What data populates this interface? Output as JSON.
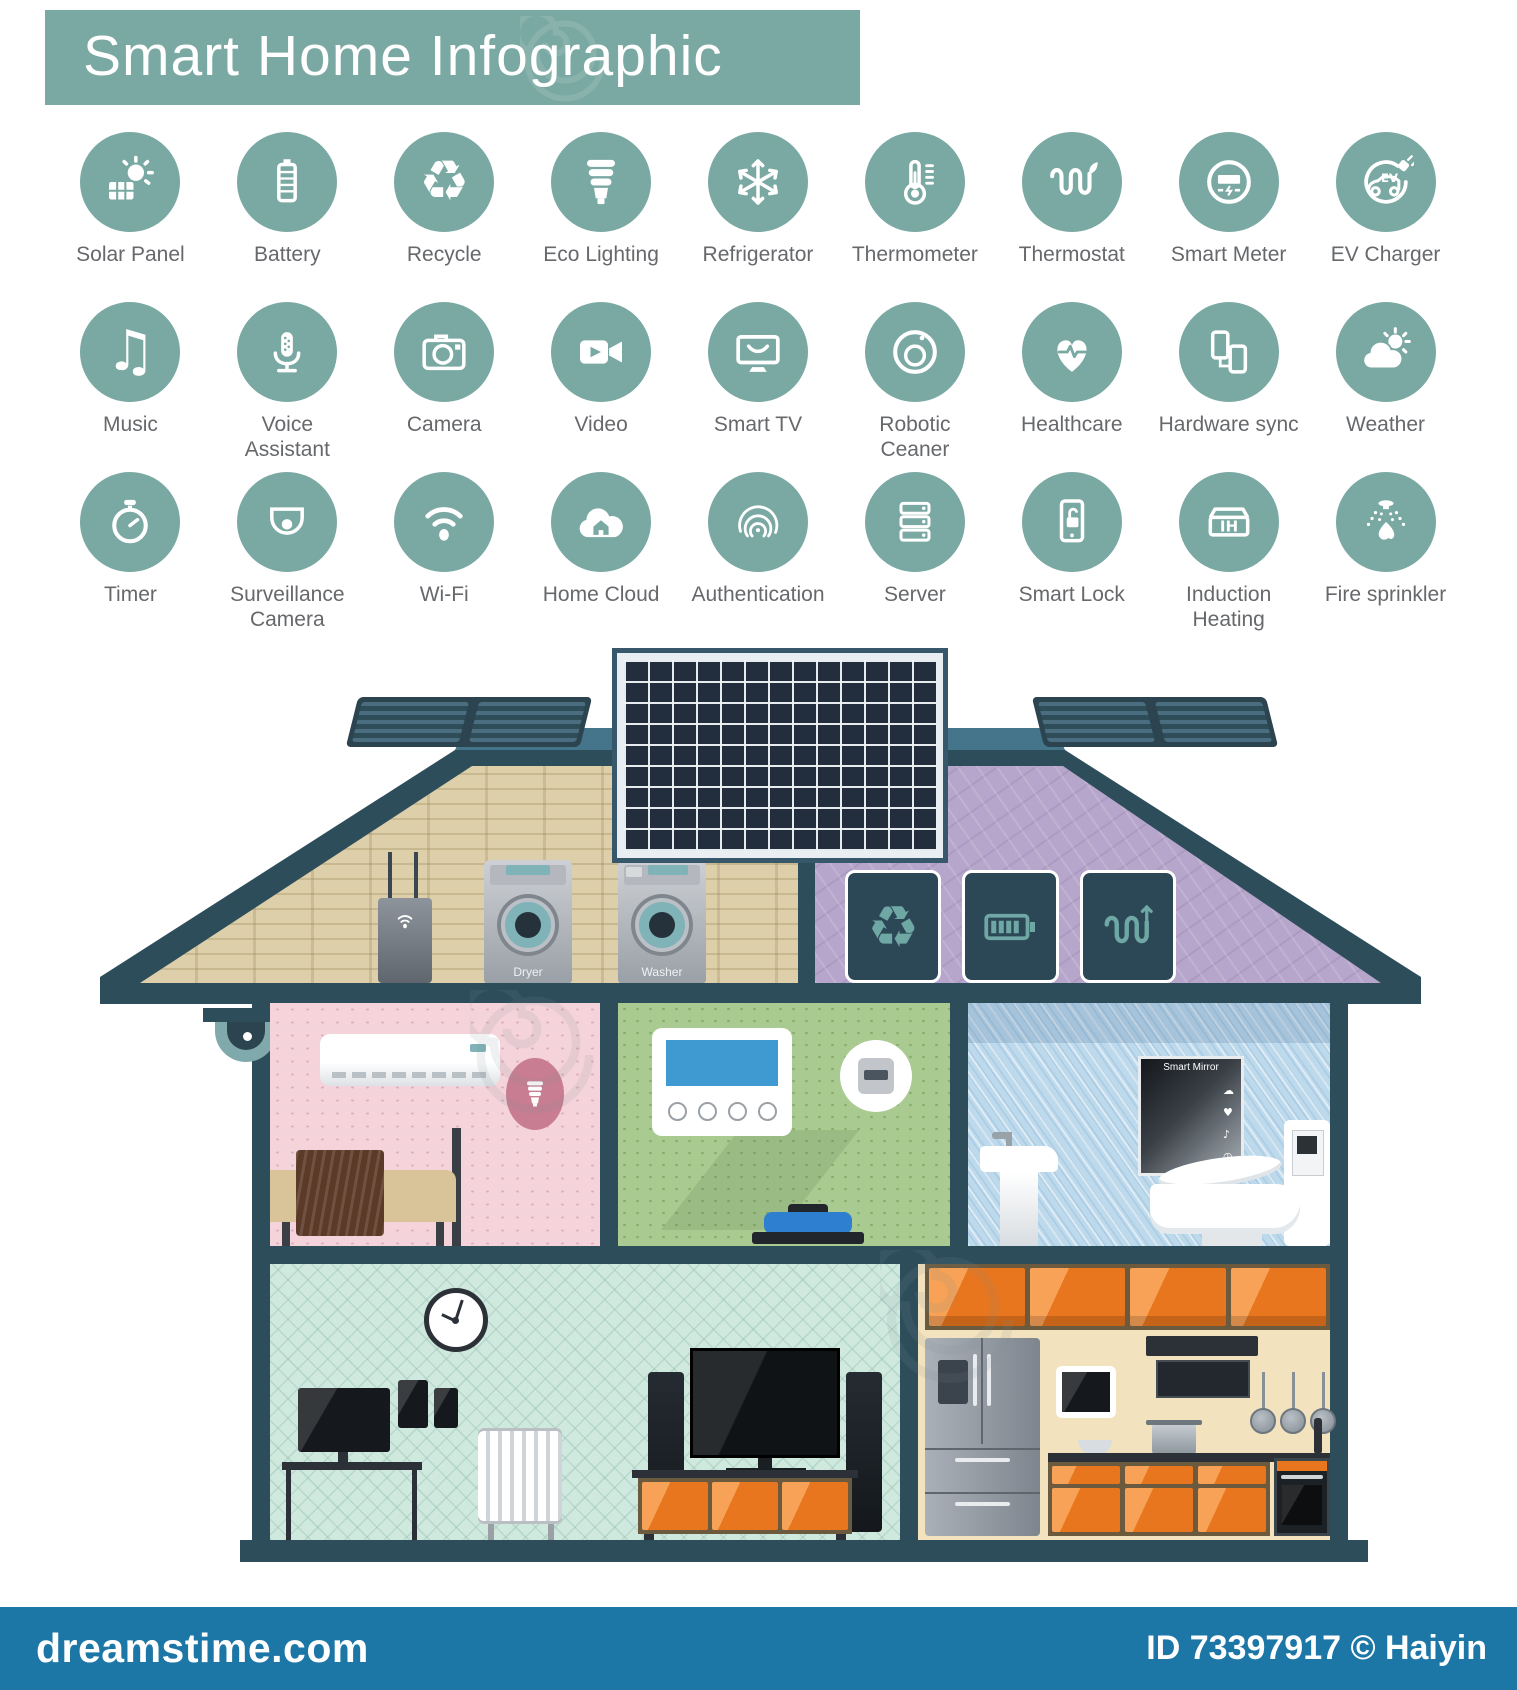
{
  "header": {
    "title": "Smart Home Infographic"
  },
  "colors": {
    "accent_teal": "#7aa8a2",
    "roof_slate": "#2d4d5b",
    "cabinet_orange": "#e8761e",
    "footer_blue": "#1c76a6"
  },
  "icon_grid": {
    "rows": [
      [
        {
          "icon": "solar-panel",
          "label": "Solar Panel"
        },
        {
          "icon": "battery",
          "label": "Battery"
        },
        {
          "icon": "recycle",
          "label": "Recycle"
        },
        {
          "icon": "eco-lighting",
          "label": "Eco Lighting"
        },
        {
          "icon": "refrigerator",
          "label": "Refrigerator"
        },
        {
          "icon": "thermometer",
          "label": "Thermometer"
        },
        {
          "icon": "thermostat",
          "label": "Thermostat"
        },
        {
          "icon": "smart-meter",
          "label": "Smart Meter"
        },
        {
          "icon": "ev-charger",
          "label": "EV Charger"
        }
      ],
      [
        {
          "icon": "music",
          "label": "Music"
        },
        {
          "icon": "voice-assistant",
          "label": "Voice\nAssistant"
        },
        {
          "icon": "camera",
          "label": "Camera"
        },
        {
          "icon": "video",
          "label": "Video"
        },
        {
          "icon": "smart-tv",
          "label": "Smart TV"
        },
        {
          "icon": "robotic-cleaner",
          "label": "Robotic\nCeaner"
        },
        {
          "icon": "healthcare",
          "label": "Healthcare"
        },
        {
          "icon": "hardware-sync",
          "label": "Hardware sync"
        },
        {
          "icon": "weather",
          "label": "Weather"
        }
      ],
      [
        {
          "icon": "timer",
          "label": "Timer"
        },
        {
          "icon": "surveillance-camera",
          "label": "Surveillance\nCamera"
        },
        {
          "icon": "wifi",
          "label": "Wi-Fi"
        },
        {
          "icon": "home-cloud",
          "label": "Home Cloud"
        },
        {
          "icon": "authentication",
          "label": "Authentication"
        },
        {
          "icon": "server",
          "label": "Server"
        },
        {
          "icon": "smart-lock",
          "label": "Smart Lock"
        },
        {
          "icon": "induction-heating",
          "label": "Induction\nHeating"
        },
        {
          "icon": "fire-sprinkler",
          "label": "Fire sprinkler"
        }
      ]
    ]
  },
  "house": {
    "attic": {
      "dryer_label": "Dryer",
      "washer_label": "Washer",
      "energy_panels": [
        "recycle",
        "battery-h",
        "heating-coil"
      ]
    },
    "bathroom": {
      "mirror_label": "Smart Mirror",
      "mirror_icons": [
        "cloud",
        "heart",
        "note",
        "clock"
      ]
    }
  },
  "footer": {
    "brand": "dreamstime.com",
    "credit": "ID 73397917 © Haiyin"
  }
}
